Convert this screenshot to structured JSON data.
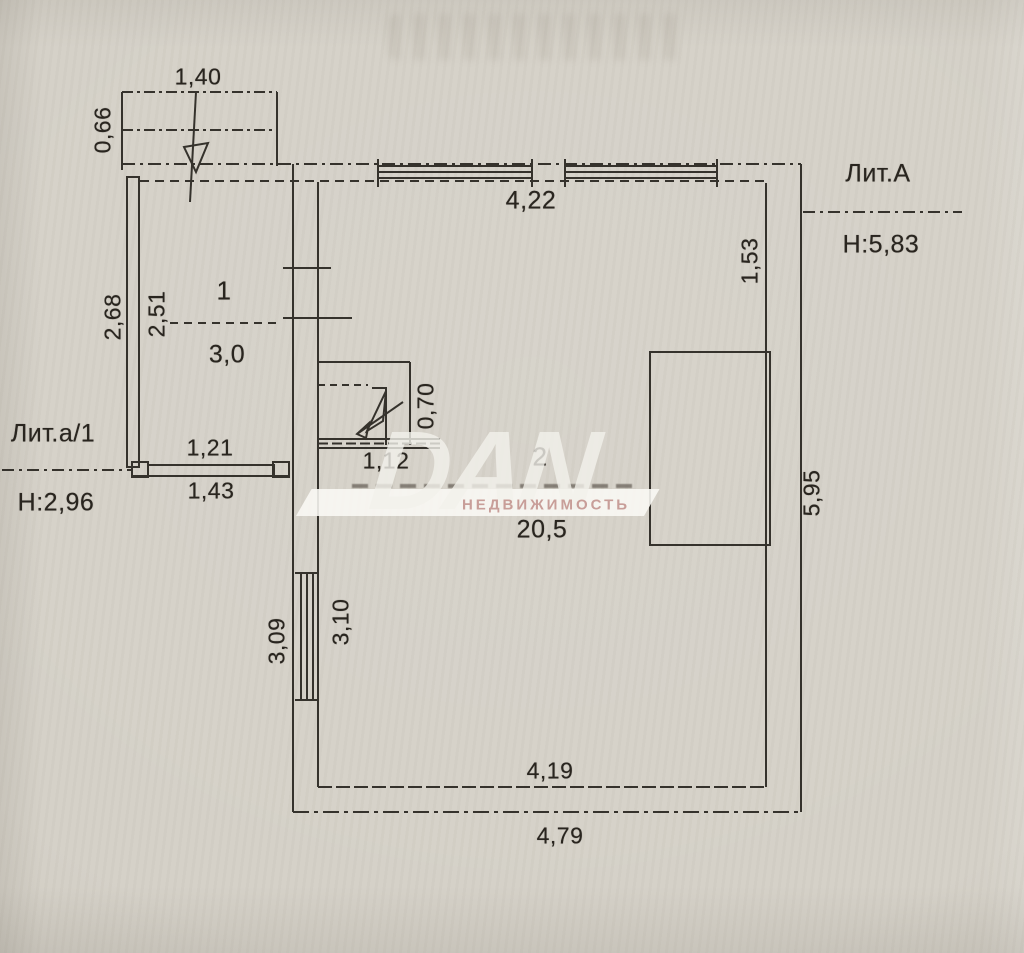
{
  "watermark": {
    "brand": "DAN",
    "subtitle": "НЕДВИЖИМОСТЬ"
  },
  "buildings": {
    "main": {
      "label": "Лит.А",
      "height_label": "Н:5,83",
      "room_number": "2",
      "room_area": "20,5"
    },
    "annex": {
      "label": "Лит.а/1",
      "height_label": "Н:2,96",
      "room_number": "1",
      "room_area": "3,0"
    }
  },
  "dimensions": {
    "porch_width": "1,40",
    "porch_depth": "0,66",
    "annex_height_outer": "2,68",
    "annex_height_inner": "2,51",
    "annex_width_inner": "1,21",
    "annex_width_outer": "1,43",
    "main_top_width": "4,22",
    "right_wall_top_segment": "1,53",
    "niche_depth": "0,70",
    "niche_width": "1,12",
    "main_right_height": "5,95",
    "left_wall_lower_outer": "3,09",
    "left_wall_lower_inner": "3,10",
    "main_bottom_inner": "4,19",
    "main_bottom_outer": "4,79"
  }
}
